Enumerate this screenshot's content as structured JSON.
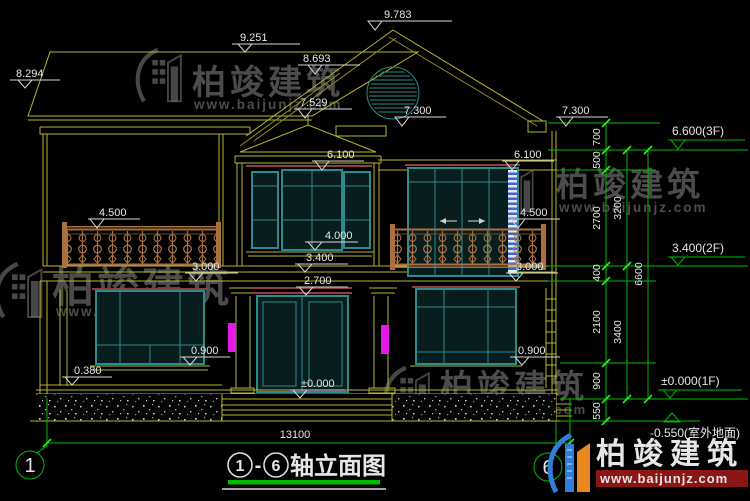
{
  "watermark": {
    "brand": "柏竣建筑",
    "url": "www.baijunjz.com"
  },
  "logo": {
    "brand": "柏竣建筑",
    "url": "www.baijunjz.com"
  },
  "title": {
    "axis_start": "1",
    "dash": "-",
    "axis_end": "6",
    "text": "轴立面图"
  },
  "axis_bubbles": {
    "left": "1",
    "right": "6"
  },
  "dims": {
    "e9783": "9.783",
    "e9251": "9.251",
    "e8693": "8.693",
    "e8294": "8.294",
    "e7529": "7.529",
    "e7300": "7.300",
    "e6100": "6.100",
    "e4500": "4.500",
    "e4000": "4.000",
    "e3400": "3.400",
    "e3000": "3.000",
    "e2700": "2.700",
    "e0900": "0.900",
    "e0380": "0.380",
    "e0000": "±0.000",
    "total_width": "13100",
    "v700": "700",
    "v500": "500",
    "v2700": "2700",
    "v3200": "3200",
    "v400": "400",
    "v2100": "2100",
    "v3400": "3400",
    "v900": "900",
    "v550": "550",
    "v6600": "6600"
  },
  "levels": {
    "f3": "6.600(3F)",
    "f2": "3.400(2F)",
    "f1": "±0.000(1F)",
    "ground": "-0.550(室外地面)"
  },
  "colors": {
    "line": "#b6b62e",
    "window": "#2e8b8b",
    "dim_green": "#00bb00",
    "lintel": "#8b4040",
    "wall_light": "#e61ae6",
    "railing": "#a9713f",
    "logo_blue": "#2f7fd9",
    "logo_orange": "#e8881f",
    "url_band_red": "#8a1616"
  }
}
